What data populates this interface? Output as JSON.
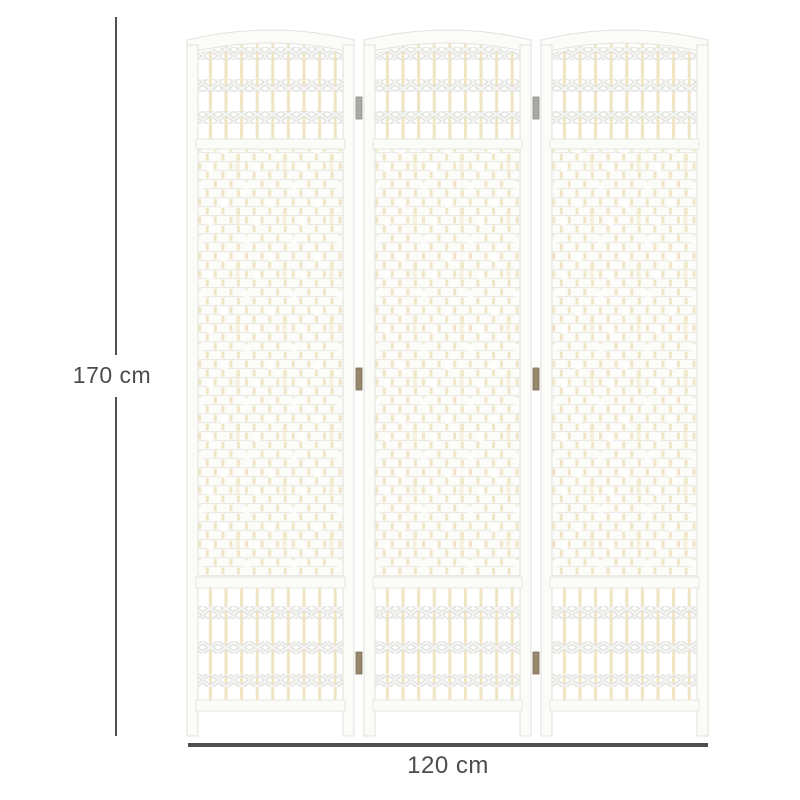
{
  "page": {
    "background": "#ffffff",
    "content_type": "product dimension illustration"
  },
  "product": {
    "name": "3-panel woven wicker folding room divider, white, arched tops",
    "panel_count": 3,
    "colors": {
      "frame_white": "#fbfbf8",
      "frame_outline": "#e2e2de",
      "wicker_accent_cream": "#f0e5c3",
      "weave_shadow": "#e2e2df",
      "hinge_brass": "#96886c"
    }
  },
  "dimensions": {
    "height": {
      "label": "170 cm",
      "value": 170,
      "unit": "cm"
    },
    "width": {
      "label": "120 cm",
      "value": 120,
      "unit": "cm"
    },
    "annotation_color": "#4f4f4f"
  }
}
